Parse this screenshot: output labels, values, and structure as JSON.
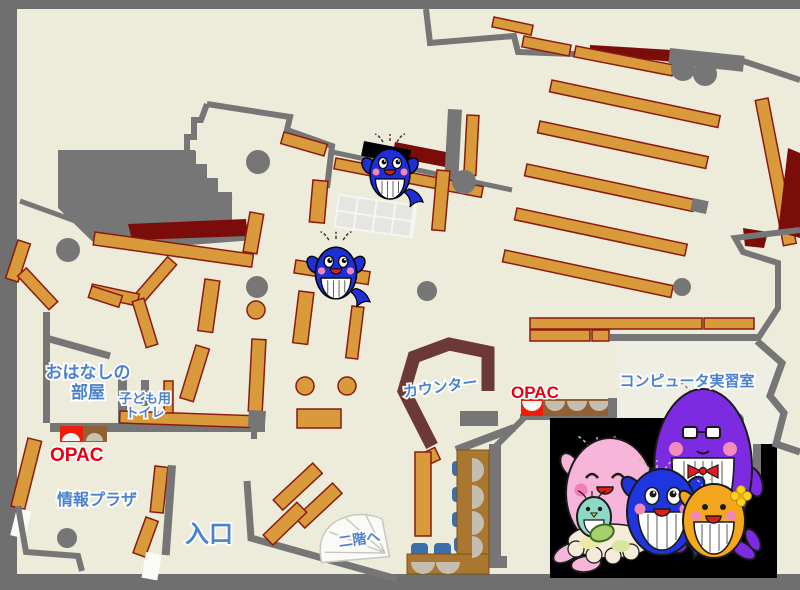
{
  "floor_map": {
    "rooms": {
      "story_room": {
        "line1": "おはなしの",
        "line2": "部屋"
      },
      "kids_toilet": {
        "line1": "子ども用",
        "line2": "トイレ"
      },
      "info_plaza": {
        "label": "情報プラザ"
      },
      "entrance": {
        "label": "入口"
      },
      "counter": {
        "label": "カウンター"
      },
      "computer_room": {
        "label": "コンピュータ実習室"
      },
      "stairs": {
        "label": "二階へ"
      },
      "opac_left": {
        "label": "OPAC"
      },
      "opac_right": {
        "label": "OPAC"
      }
    },
    "colors": {
      "floor": "#EDEBDA",
      "outer_background": "#6F6F6F",
      "wall": "#767676",
      "shelf": "#D89A3A",
      "shelf_border": "#8B1B10",
      "dark_red_area": "#7A0D09",
      "counter": "#6C3936",
      "label_blue": "#4B82CE",
      "opac_red": "#E60012",
      "opac_terminal_red": "#EE1C0E",
      "chair_blue": "#3C6FA8",
      "table_brown": "#A9772F",
      "photo_background": "#000000",
      "mascot_blue": "#1F2FD6",
      "mascot_pink": "#F6B5D9",
      "mascot_purple": "#7D2BE0",
      "mascot_orange": "#F4A61F",
      "mascot_teal": "#8FD8C8"
    },
    "mascots": {
      "map_whale_stickers": 2,
      "family": [
        "pink-whale",
        "teal-baby-whale",
        "blue-whale",
        "purple-whale",
        "orange-whale"
      ]
    }
  }
}
